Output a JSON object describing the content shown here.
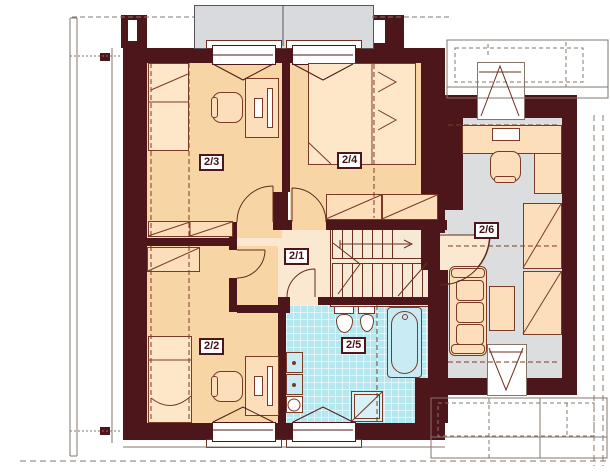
{
  "plan": {
    "type": "architectural-floor-plan",
    "storey_rooms": [
      {
        "label": "2/1"
      },
      {
        "label": "2/2"
      },
      {
        "label": "2/3"
      },
      {
        "label": "2/4"
      },
      {
        "label": "2/5"
      },
      {
        "label": "2/6"
      }
    ],
    "colors": {
      "wall": "#4c161a",
      "bedroom_floor": "#f8d5a5",
      "hall_floor": "#fbe8d0",
      "bathroom_tile": "#b5e7ef",
      "office_floor": "#dcddde",
      "dormer_roof": "#d8dade",
      "furniture_outline": "#7a3a26",
      "thin_structure_line": "#857468"
    }
  }
}
